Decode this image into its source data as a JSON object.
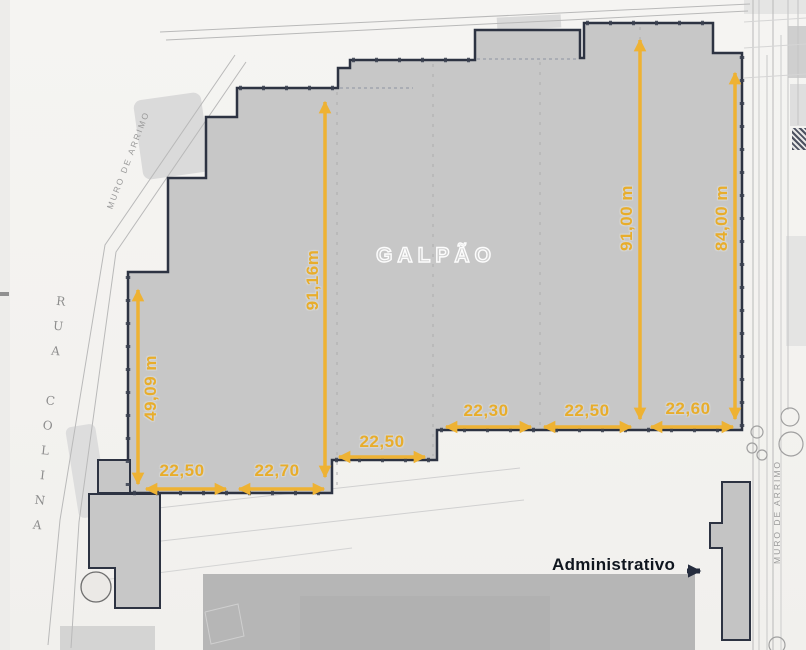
{
  "plan": {
    "title": "GALPÃO",
    "admin_label": "Administrativo",
    "street_label": "RUA COLINA",
    "wall_label_left": "MURO DE ARRIMO",
    "wall_label_right": "MURO DE ARRIMO",
    "colors": {
      "dimension_accent": "#e8ad2b",
      "building_outline": "#2d3342",
      "building_fill": "#c7c7c7",
      "admin_text": "#10161f"
    },
    "dimensions": {
      "vertical": [
        {
          "side": "far-left",
          "label": "49,09 m"
        },
        {
          "side": "left-middle",
          "label": "91,16m"
        },
        {
          "side": "right-middle",
          "label": "91,00 m"
        },
        {
          "side": "far-right",
          "label": "84,00 m"
        }
      ],
      "horizontal": [
        {
          "bay": 1,
          "label": "22,50"
        },
        {
          "bay": 2,
          "label": "22,70"
        },
        {
          "bay": 3,
          "label": "22,50"
        },
        {
          "bay": 4,
          "label": "22,30"
        },
        {
          "bay": 5,
          "label": "22,50"
        },
        {
          "bay": 6,
          "label": "22,60"
        }
      ]
    }
  }
}
